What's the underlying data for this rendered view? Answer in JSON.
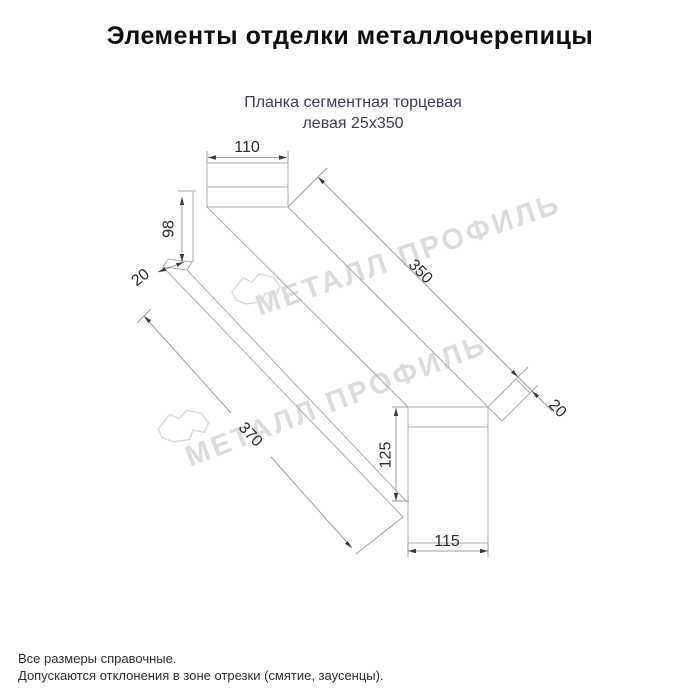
{
  "header": {
    "title": "Элементы отделки металлочерепицы"
  },
  "product": {
    "name_line1": "Планка сегментная торцевая",
    "name_line2": "левая 25х350"
  },
  "drawing": {
    "kind": "isometric technical drawing of end trim strip",
    "dimensions": {
      "top_face_width": "110",
      "near_side_height": "98",
      "near_flange": "20",
      "top_edge_length": "350",
      "body_length": "370",
      "far_flange": "20",
      "far_end_height": "125",
      "far_end_width": "115"
    }
  },
  "watermark": {
    "text": "МЕТАЛЛ ПРОФИЛЬ"
  },
  "footer": {
    "note1": "Все размеры справочные.",
    "note2": "Допускаются отклонения в зоне отрезки (смятие, заусенцы)."
  },
  "colors": {
    "line": "#aaaab2",
    "dimension_line": "#9d9da6",
    "arrow": "#3a3a3a",
    "dimension_text": "#2b2b2b",
    "subtitle_text": "#3c3c55",
    "watermark": "#dcdcdc"
  }
}
